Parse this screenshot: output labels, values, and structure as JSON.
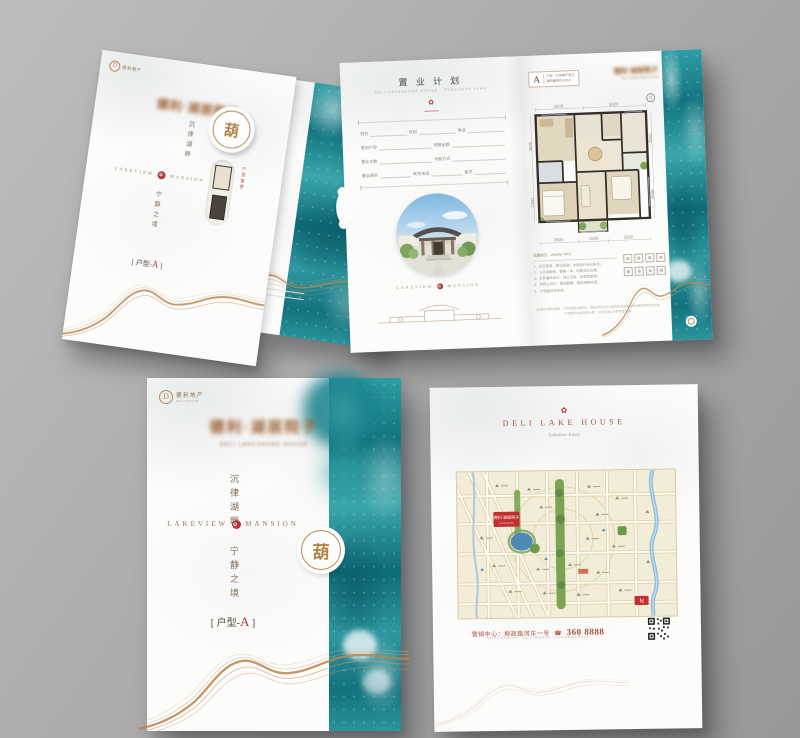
{
  "folded": {
    "logo_mark": "D",
    "logo": "德利地产",
    "blurred_title": "德利·湖居院子",
    "vertical_top": "沉律湖畔",
    "brand_left": "LAKEVIEW",
    "seal": "✿",
    "brand_right": "MANSION",
    "vertical_bottom": "宁静之境",
    "type_label_prefix": "[ 户型-",
    "type_letter": "A",
    "type_label_suffix": " ]",
    "tab_char": "葫",
    "inside_red_text": "户型鉴赏"
  },
  "spread": {
    "left": {
      "title": "置 业 计 划",
      "subtitle": "DELI LAKESHORE HOUSE · PURCHASE PLAN",
      "seal": "✿",
      "form": {
        "row1": [
          "姓名",
          "性别",
          "电话"
        ],
        "row2": [
          "意向户型",
          "预算金额"
        ],
        "row3": [
          "置业次数",
          "付款方式"
        ],
        "row4": [
          "置业顾问",
          "联系电话",
          "备注"
        ]
      },
      "brand_left": "LAKEVIEW",
      "brand_seal": "✿",
      "brand_right": "MANSION"
    },
    "right": {
      "badge_letter": "A",
      "badge_line1": "户型 · 三室两厅两卫",
      "badge_line2": "建筑面积约128㎡",
      "blurred_logo": "德利·湖居院子",
      "blurred_logo_sub": "DELI LAKESHORE HOUSE",
      "compass": "北",
      "dims": {
        "top": [
          "3300",
          "3900"
        ],
        "bottom": [
          "3600",
          "1500",
          "3300"
        ],
        "left": [
          "3600",
          "3300"
        ],
        "right": [
          "2900",
          "4500"
        ]
      },
      "notes_title": "温馨提示 · WARM TIPS",
      "notes": [
        "1、方正格局，南北通透，全明设计采光充足；",
        "2、三开间朝南，餐客一体，动静分区合理；",
        "3、主卧套房设计，独立卫浴，私密性更佳；",
        "4、双阳台设计，赠送飘窗，景观视野开阔；",
        "5、户型图仅供参考。"
      ],
      "disclaimer1": "本资料为要约邀请，不构成要约或承诺，相关权利义务以政府批文及商品房买卖合同约定为准。",
      "disclaimer2": "户型图为装修效果示意，交付标准以合同约定为准。"
    }
  },
  "cover": {
    "logo_mark": "D",
    "logo_name": "德利地产",
    "logo_sub": "DELI ESTATE",
    "blurred_title": "德利·湖居院子",
    "blurred_sub": "DELI LAKESHORE HOUSE",
    "vertical_top": "沉律湖畔",
    "brand_left": "LAKEVIEW",
    "seal": "✿",
    "brand_right": "MANSION",
    "vertical_bottom": "宁静之境",
    "type_label_prefix": "[ 户型-",
    "type_letter": "A",
    "type_label_suffix": " ]",
    "tab_char": "葫"
  },
  "back": {
    "seal": "✿",
    "brand": "DELI LAKE HOUSE",
    "brand_sub": "Lakeshore Estate",
    "map_marker": "德利·湖居院子",
    "map_marker_sub": "LAKESHORE",
    "map_compass": "N",
    "contact_cn": "营销中心：柳政路河东一号",
    "phone_icon": "☎",
    "phone": "360 8888",
    "contact_en": "SALES CENTER：NO.1 HEDONG · LIUZHENG ROAD"
  }
}
